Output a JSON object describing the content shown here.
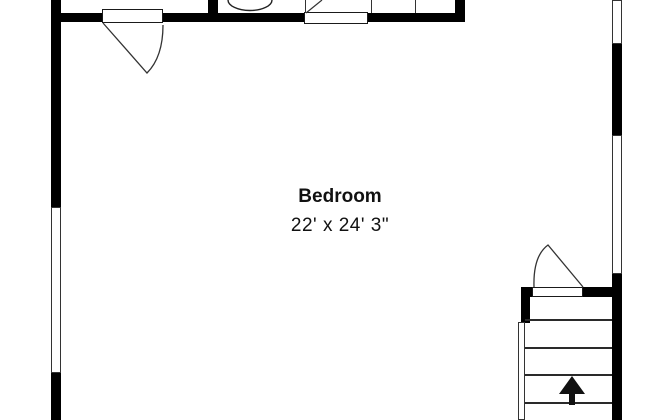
{
  "room": {
    "name": "Bedroom",
    "dimensions": "22' x 24' 3\""
  },
  "stairs": {
    "arrow_direction": "up",
    "visible_tread_lines": 4
  },
  "colors": {
    "wall": "#000000",
    "background": "#ffffff",
    "line": "#333333"
  }
}
